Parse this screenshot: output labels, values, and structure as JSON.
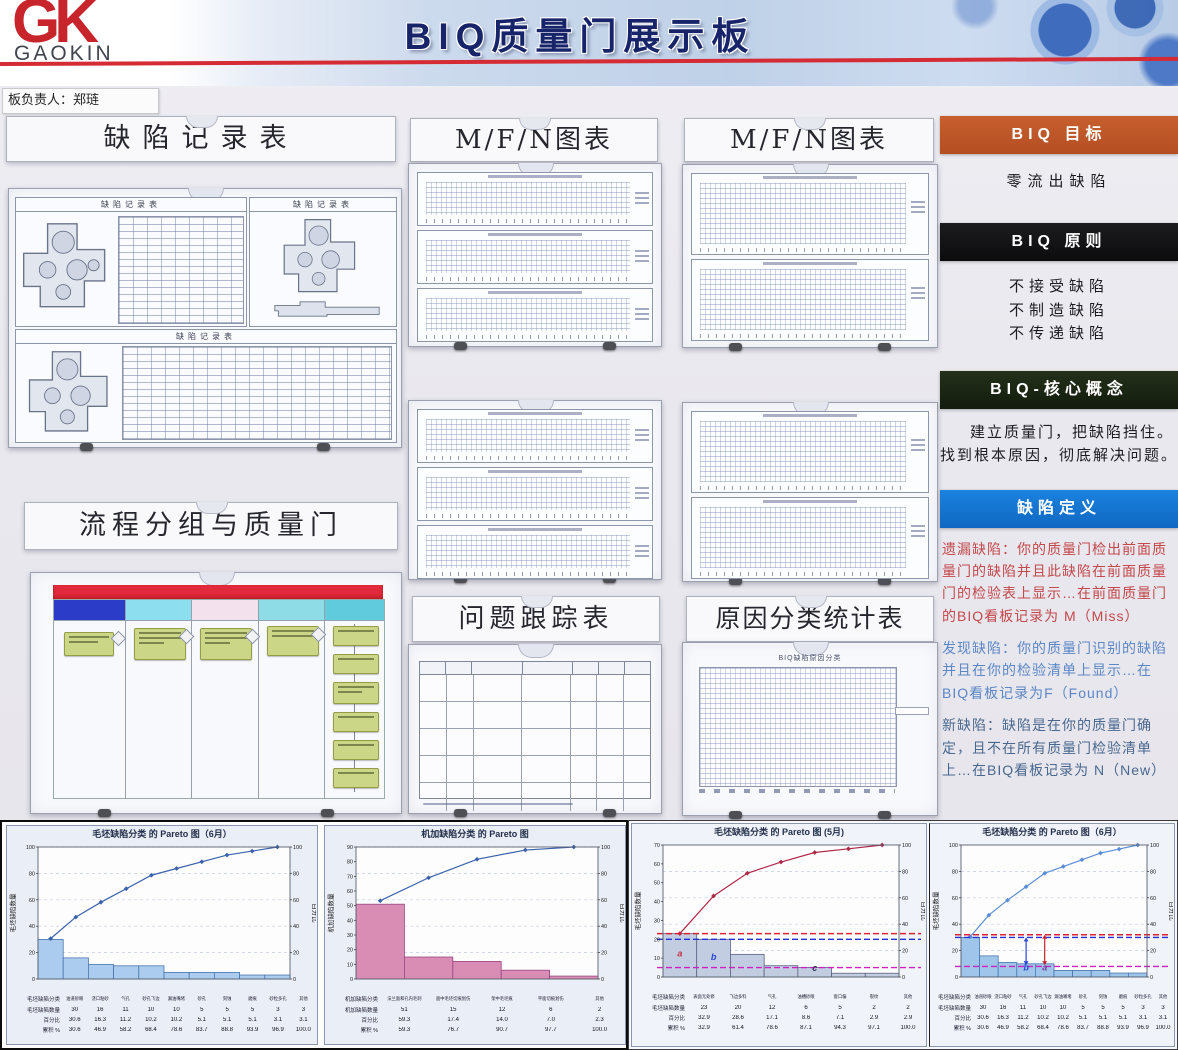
{
  "header": {
    "logo_main": "GK",
    "logo_sub": "GAOKIN",
    "title": "BIQ质量门展示板",
    "owner_label": "板负责人：郑琏"
  },
  "left_column": {
    "defect_record_title": "缺陷记录表",
    "sheet_form_title": "缺陷记录表",
    "flow_title": "流程分组与质量门"
  },
  "middle": {
    "mfn_title_1": "M/F/N图表",
    "mfn_title_2": "M/F/N图表",
    "problem_title": "问题跟踪表",
    "cause_title": "原因分类统计表",
    "cause_chart_title": "BIQ缺陷原因分类"
  },
  "right_panel": {
    "sections": [
      {
        "heading": "BIQ 目标",
        "heading_bg": "#bb531f",
        "body": [
          "零流出缺陷"
        ]
      },
      {
        "heading": "BIQ 原则",
        "heading_bg": "#121214",
        "body": [
          "不接受缺陷",
          "不制造缺陷",
          "不传递缺陷"
        ]
      },
      {
        "heading": "BIQ-核心概念",
        "heading_bg": "#1a2612",
        "body": [
          "建立质量门，把缺陷挡住。",
          "找到根本原因，彻底解决问题。"
        ]
      },
      {
        "heading": "缺陷定义",
        "heading_bg": "#1374d4",
        "paragraphs": [
          {
            "text": "遗漏缺陷：你的质量门检出前面质量门的缺陷并且此缺陷在前面质量门的检验表上显示…在前面质量门的BIQ看板记录为 M（Miss）",
            "color": "#c4484c"
          },
          {
            "text": "发现缺陷：你的质量门识别的缺陷并且在你的检验清单上显示…在BIQ看板记录为F（Found）",
            "color": "#5b87c6"
          },
          {
            "text": "新缺陷：缺陷是在你的质量门确定，且不在所有质量门检验清单上…在BIQ看板记录为 N（New）",
            "color": "#49688f"
          }
        ]
      }
    ]
  },
  "chart_data": [
    {
      "type": "bar",
      "title": "毛坯缺陷分类 的 Pareto 图（6月）",
      "ylabel": "毛坯缺陷数量",
      "y2label": "百分比",
      "ymax": 100,
      "ystep": 20,
      "y2max": 100,
      "y2step": 20,
      "bar_fill": "#abccee",
      "bar_stroke": "#4a76ad",
      "line_color": "#3a62ac",
      "row_labels": [
        "毛坯缺陷分类",
        "毛坯缺陷数量",
        "百分比",
        "累积 %"
      ],
      "categories": [
        "油道砂眼",
        "浇口粘砂",
        "气孔",
        "砂孔飞边",
        "漏油嘴堵",
        "砂孔",
        "刻蚀",
        "磨痕",
        "砂粒多孔",
        "其他"
      ],
      "counts": [
        30,
        16,
        11,
        10,
        10,
        5,
        5,
        5,
        3,
        3
      ],
      "percents": [
        "30.6",
        "16.3",
        "11.2",
        "10.2",
        "10.2",
        "5.1",
        "5.1",
        "5.1",
        "3.1",
        "3.1"
      ],
      "cumulative": [
        "30.6",
        "46.9",
        "58.2",
        "68.4",
        "78.6",
        "83.7",
        "88.8",
        "93.9",
        "96.9",
        "100.0"
      ],
      "ref_lines": [],
      "annotations": [],
      "arrows": []
    },
    {
      "type": "bar",
      "title": "机加缺陷分类 的 Pareto 图",
      "ylabel": "机加缺陷数量",
      "y2label": "百分比",
      "ymax": 90,
      "ystep": 10,
      "y2max": 100,
      "y2step": 20,
      "bar_fill": "#d98cb4",
      "bar_stroke": "#9a4680",
      "line_color": "#3a62ac",
      "row_labels": [
        "机加缺陷分类",
        "机加缺陷数量",
        "百分比",
        "累积 %"
      ],
      "categories": [
        "法兰面和孔内毛刺",
        "面中毛坯切痕划伤",
        "架中毛坯痕",
        "平面切痕划伤",
        "其他"
      ],
      "counts": [
        51,
        15,
        12,
        6,
        2
      ],
      "percents": [
        "59.3",
        "17.4",
        "14.0",
        "7.0",
        "2.3"
      ],
      "cumulative": [
        "59.3",
        "76.7",
        "90.7",
        "97.7",
        "100.0"
      ],
      "ref_lines": [],
      "annotations": [],
      "arrows": []
    },
    {
      "type": "bar",
      "title": "毛坯缺陷分类 的 Pareto 图 (5月)",
      "ylabel": "毛坯缺陷数量",
      "y2label": "百分比",
      "ymax": 70,
      "ystep": 10,
      "y2max": 100,
      "y2step": 20,
      "bar_fill": "#c3cde2",
      "bar_stroke": "#5a6480",
      "line_color": "#b02848",
      "row_labels": [
        "毛坯缺陷分类",
        "毛坯缺陷数量",
        "百分比",
        "累积 %"
      ],
      "categories": [
        "表面无处修",
        "飞边多料",
        "气孔",
        "油槽砂眼",
        "窗口偏",
        "裂纹",
        "其他"
      ],
      "counts": [
        23,
        20,
        12,
        6,
        5,
        2,
        2
      ],
      "percents": [
        "32.9",
        "28.6",
        "17.1",
        "8.6",
        "7.1",
        "2.9",
        "2.9"
      ],
      "cumulative": [
        "32.9",
        "61.4",
        "78.6",
        "87.1",
        "94.3",
        "97.1",
        "100.0"
      ],
      "ref_lines": [
        {
          "y": 23,
          "color": "#e02030"
        },
        {
          "y": 20,
          "color": "#2030dd"
        },
        {
          "y": 5,
          "color": "#d020c0"
        }
      ],
      "annotations": [
        {
          "bar": 0,
          "at": 11,
          "label": "a",
          "color": "#c03040"
        },
        {
          "bar": 1,
          "at": 9,
          "label": "b",
          "color": "#2746d8"
        },
        {
          "bar": 4,
          "at": 3.2,
          "label": "c",
          "color": "#2a3550"
        }
      ],
      "arrows": []
    },
    {
      "type": "bar",
      "title": "毛坯缺陷分类 的 Pareto 图（6月）",
      "ylabel": "毛坯缺陷数量",
      "y2label": "百分比",
      "ymax": 100,
      "ystep": 20,
      "y2max": 100,
      "y2step": 20,
      "bar_fill": "#9fc6ea",
      "bar_stroke": "#4a76ad",
      "line_color": "#5b8ed6",
      "row_labels": [
        "毛坯缺陷分类",
        "毛坯缺陷数量",
        "百分比",
        "累积 %"
      ],
      "categories": [
        "油道砂眼",
        "浇口粘砂",
        "气孔",
        "砂孔飞边",
        "漏油嘴堵",
        "砂孔",
        "刻蚀",
        "磨痕",
        "砂粒多孔",
        "其他"
      ],
      "counts": [
        30,
        16,
        11,
        10,
        10,
        5,
        5,
        5,
        3,
        3
      ],
      "percents": [
        "30.6",
        "16.3",
        "11.2",
        "10.2",
        "10.2",
        "5.1",
        "5.1",
        "5.1",
        "3.1",
        "3.1"
      ],
      "cumulative": [
        "30.6",
        "46.9",
        "58.2",
        "68.4",
        "78.6",
        "83.7",
        "88.8",
        "93.9",
        "96.9",
        "100.0"
      ],
      "ref_lines": [
        {
          "y": 32,
          "color": "#e02030"
        },
        {
          "y": 30,
          "color": "#2030dd"
        },
        {
          "y": 8,
          "color": "#d020c0"
        }
      ],
      "annotations": [
        {
          "bar": 3,
          "at": 5,
          "label": "b",
          "color": "#2746d8"
        },
        {
          "bar": 4,
          "at": 5,
          "label": "a",
          "color": "#7a3a9a"
        }
      ],
      "arrows": [
        {
          "bar": 3,
          "from": 30,
          "to": 9,
          "color": "#2746d8"
        },
        {
          "bar": 4,
          "from": 32,
          "to": 9,
          "color": "#cc2030"
        }
      ]
    }
  ],
  "palette": {
    "header_red_line": "#d42b35",
    "flow_header_red": "#e12a3c",
    "banner_goal": "#bb531f",
    "banner_principle": "#121214",
    "banner_core": "#1a2612",
    "banner_defect": "#1374d4"
  }
}
